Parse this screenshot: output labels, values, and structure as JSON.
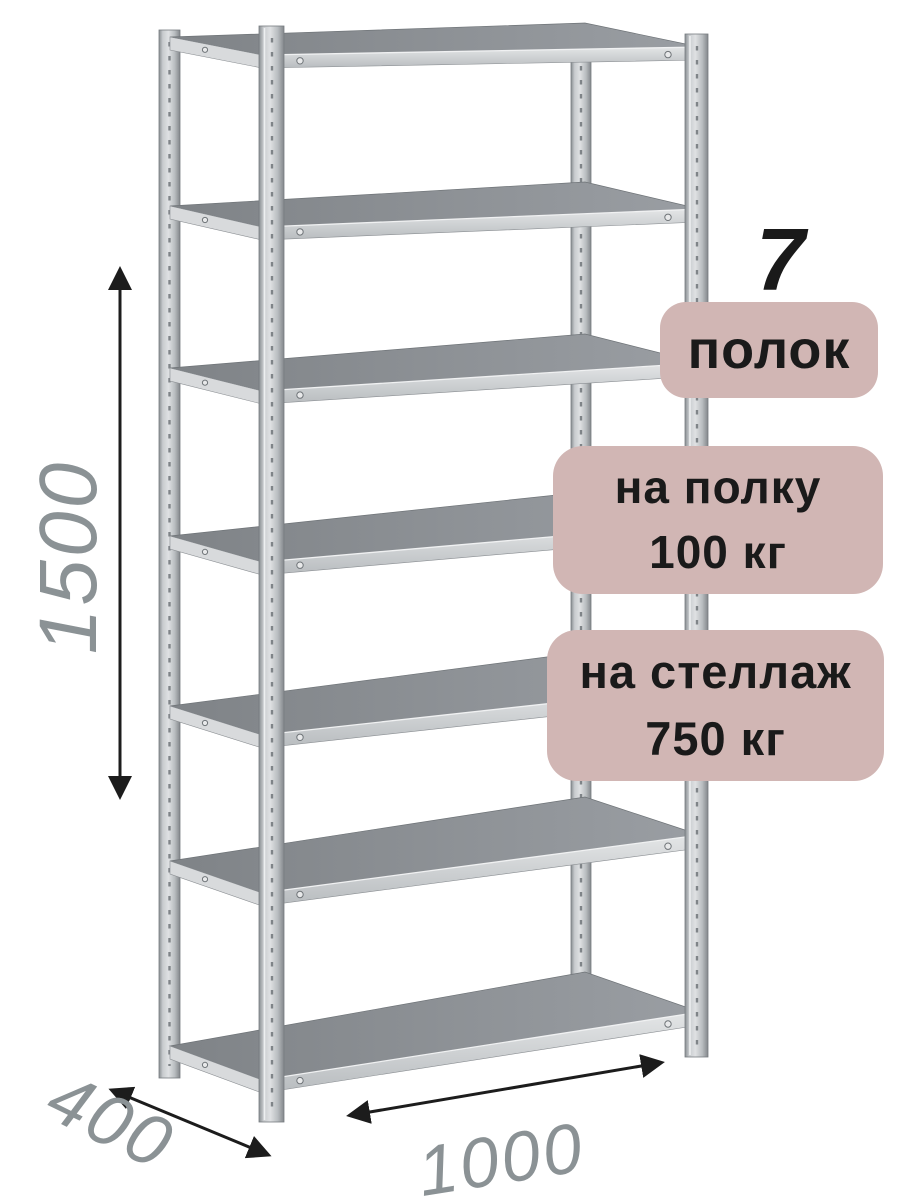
{
  "badges": {
    "count_number": "7",
    "count_label": "полок",
    "per_shelf": {
      "line1": "на полку",
      "line2": "100 кг"
    },
    "per_rack": {
      "line1": "на стеллаж",
      "line2": "750 кг"
    }
  },
  "dimensions": {
    "height": "1500",
    "depth": "400",
    "width": "1000"
  },
  "shelving": {
    "shelf_count": 7
  },
  "colors": {
    "background": "#ffffff",
    "badge_bg": "#d1b6b4",
    "badge_text": "#1a1a1a",
    "dimension_text": "#8b9295",
    "arrow": "#1c1c1c"
  }
}
